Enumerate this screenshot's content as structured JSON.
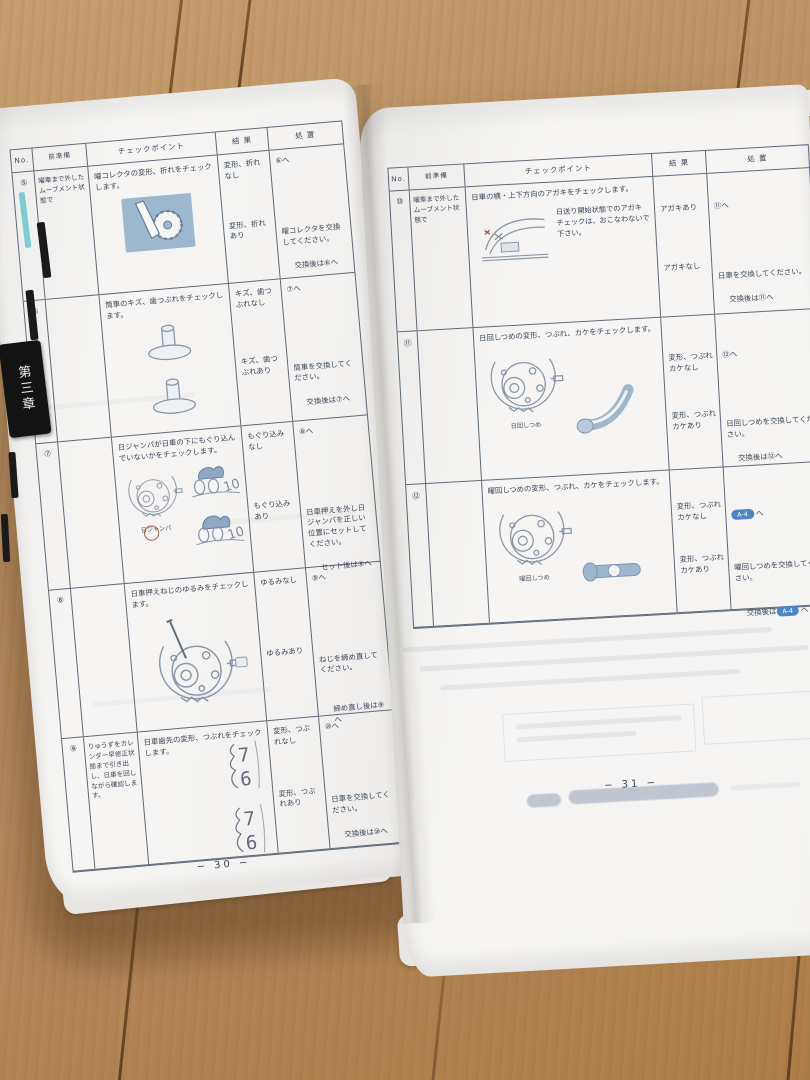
{
  "chapter_tab": "第三章",
  "left_page": {
    "page_number": "− 30 −",
    "headers": {
      "no": "No.",
      "prep": "前準備",
      "checkpoint": "チェックポイント",
      "result": "結  果",
      "action": "処  置"
    },
    "rows": [
      {
        "no": "⑤",
        "prep": "曜車まで外したムーブメント状態で",
        "checkpoint": "曜コレクタの変形、折れをチェックします。",
        "outcomes": [
          {
            "result": "変形、折れ\nなし",
            "action_1": "⑥へ"
          },
          {
            "result": "変形、折れ\nあり",
            "action_1": "曜コレクタを交換してください。",
            "action_2": "交換後は⑥へ"
          }
        ]
      },
      {
        "no": "⑥",
        "prep": "",
        "checkpoint": "筒車のキズ、歯つぶれをチェックします。",
        "outcomes": [
          {
            "result": "キズ、歯つ\nぶれなし",
            "action_1": "⑦へ"
          },
          {
            "result": "キズ、歯つ\nぶれあり",
            "action_1": "筒車を交換してください。",
            "action_2": "交換後は⑦へ"
          }
        ]
      },
      {
        "no": "⑦",
        "prep": "",
        "checkpoint": "日ジャンパが日車の下にもぐり込んでいないかをチェックします。",
        "figure_label": "日ジャンパ",
        "outcomes": [
          {
            "result": "もぐり込み\nなし",
            "action_1": "⑧へ"
          },
          {
            "result": "もぐり込み\nあり",
            "action_1": "日車押えを外し日ジャンパを正しい位置にセットしてください。",
            "action_2": "セット後は⑧へ"
          }
        ]
      },
      {
        "no": "⑧",
        "prep": "",
        "checkpoint": "日車押えねじのゆるみをチェックします。",
        "outcomes": [
          {
            "result": "ゆるみなし",
            "action_1": "⑨へ"
          },
          {
            "result": "ゆるみあり",
            "action_1": "ねじを締め直してください。",
            "action_2": "締め直し後は⑨へ"
          }
        ]
      },
      {
        "no": "⑨",
        "prep": "りゅうずをカレンダー早修正状態まで引き出し、日車を回しながら確認します。",
        "checkpoint": "日車歯先の変形、つぶれをチェックします。",
        "numeral_top": "7",
        "numeral_bottom": "6",
        "outcomes": [
          {
            "result": "変形、つぶ\nれなし",
            "action_1": "⑩へ"
          },
          {
            "result": "変形、つぶ\nれあり",
            "action_1": "日車を交換してください。",
            "action_2": "交換後は⑩へ"
          }
        ]
      }
    ]
  },
  "right_page": {
    "page_number": "− 31 −",
    "headers": {
      "no": "No.",
      "prep": "前準備",
      "checkpoint": "チェックポイント",
      "result": "結  果",
      "action": "処  置"
    },
    "rows": [
      {
        "no": "⑩",
        "prep": "曜車まで外したムーブメント状態で",
        "checkpoint": "日車の横・上下方向のアガキをチェックします。",
        "note": "日送り開始状態でのアガキチェックは、おこなわないで下さい。",
        "outcomes": [
          {
            "result": "アガキあり",
            "action_1": "⑪へ"
          },
          {
            "result": "アガキなし",
            "action_1": "日車を交換してください。",
            "action_2": "交換後は⑪へ"
          }
        ]
      },
      {
        "no": "⑪",
        "prep": "",
        "checkpoint": "日回しつめの変形、つぶれ、カケをチェックします。",
        "figure_label": "日回しつめ",
        "outcomes": [
          {
            "result": "変形、つぶれ\nカケなし",
            "action_1": "⑫へ"
          },
          {
            "result": "変形、つぶれ\nカケあり",
            "action_1": "日回しつめを交換してください。",
            "action_2": "交換後は⑫へ"
          }
        ]
      },
      {
        "no": "⑫",
        "prep": "",
        "checkpoint": "曜回しつめの変形、つぶれ、カケをチェックします。",
        "figure_label": "曜回しつめ",
        "outcomes": [
          {
            "result": "変形、つぶれ\nカケなし",
            "badge": "A-4",
            "after_badge": "へ"
          },
          {
            "result": "変形、つぶれ\nカケあり",
            "action_1": "曜回しつめを交換してください。",
            "action_2_pre": "交換後は",
            "badge": "A-4",
            "after_badge": "へ"
          }
        ]
      }
    ]
  },
  "colors": {
    "badge_blue": "#4f84c4",
    "illustration_blue": "#9db7ce",
    "table_line": "#5f6b7a",
    "floor_wood": "#b4885a"
  }
}
